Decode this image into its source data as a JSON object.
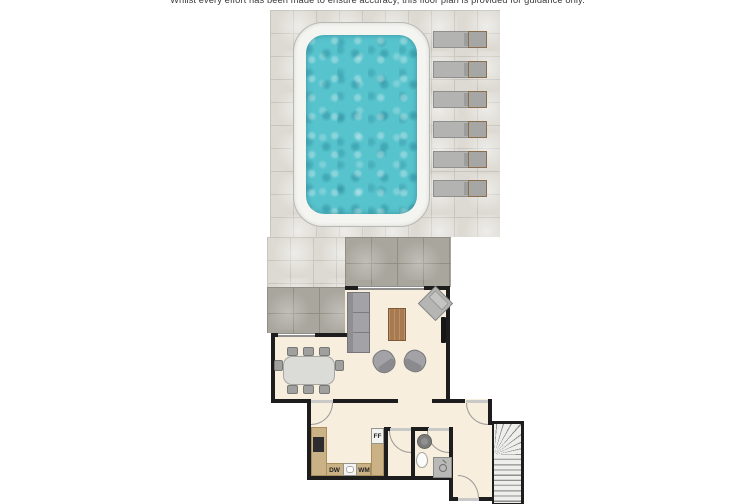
{
  "disclaimer": "Whilst every effort has been made to ensure accuracy, this floor plan is provided for guidance only.",
  "appliance_labels": {
    "fridge_freezer": "FF",
    "dishwasher": "DW",
    "washing_machine": "WM"
  },
  "colors": {
    "wall": "#1d1d1d",
    "floor": "#f7eedd",
    "tileLight": "#dddad3",
    "tileDark": "#a9a69d",
    "poolWater": "#57c3cd",
    "poolDeck": "#f4f4f1",
    "counter": "#cbb286",
    "wood": "#a87a4e",
    "furnGray": "#a3a3a7",
    "tableGray": "#dbdbd8",
    "stairTread": "#eeeeec",
    "loungerGray": "#b3b3b1"
  }
}
